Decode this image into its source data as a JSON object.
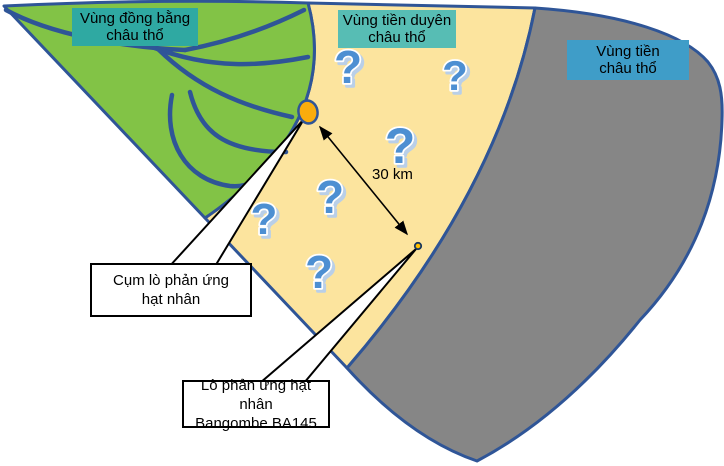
{
  "zones": [
    {
      "name": "delta-plain",
      "label_line1": "Vùng đồng bằng",
      "label_line2": "châu thổ",
      "fill": "#82C346",
      "label_bg": "#2FA9A2"
    },
    {
      "name": "delta-front",
      "label_line1": "Vùng tiền duyên",
      "label_line2": "châu thổ",
      "fill": "#FCE49E",
      "label_bg": "#57BDB4"
    },
    {
      "name": "prodelta",
      "label_line1": "Vùng tiền",
      "label_line2": "châu thổ",
      "fill": "#868686",
      "label_bg": "#3F9DC8"
    }
  ],
  "callouts": {
    "reactor_cluster_line1": "Cụm lò phản ứng",
    "reactor_cluster_line2": "hạt nhân",
    "bangombe_line1": "Lò phản ứng hạt nhân",
    "bangombe_line2": "Bangombe BA145"
  },
  "distance": {
    "label": "30 km"
  },
  "question_marks": {
    "glyph": "?",
    "fill": "#4E8FD2",
    "outline": "#FFFFFF",
    "shadow": "#B9CFE8",
    "positions": [
      {
        "x": 348,
        "y": 83,
        "size": 46
      },
      {
        "x": 455,
        "y": 90,
        "size": 42
      },
      {
        "x": 400,
        "y": 163,
        "size": 50
      },
      {
        "x": 330,
        "y": 213,
        "size": 46
      },
      {
        "x": 264,
        "y": 234,
        "size": 44
      },
      {
        "x": 319,
        "y": 288,
        "size": 46
      }
    ]
  },
  "colors": {
    "outline": "#2F5597",
    "river": "#2F5597",
    "reactor_cluster_fill": "#F9AC0C",
    "bangombe_fill": "#FFC000",
    "arrow": "#000000",
    "background": "#FFFFFF"
  }
}
